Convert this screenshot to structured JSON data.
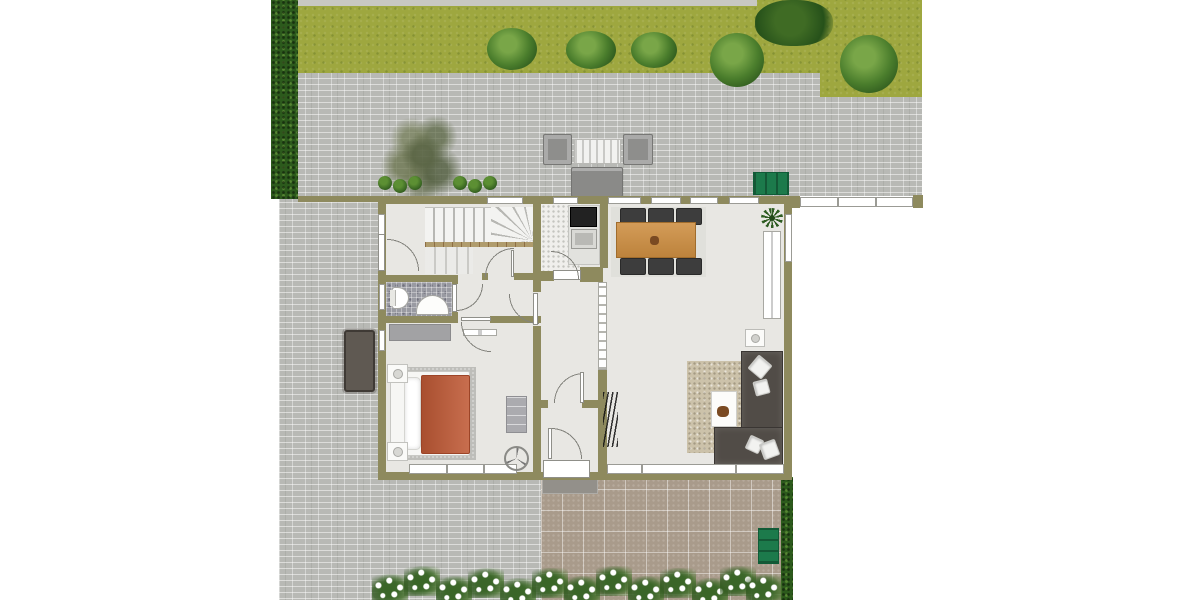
{
  "meta": {
    "title": "Ground floor plan with garden",
    "type": "floor-plan"
  },
  "palette": {
    "wall": "#8e8a5e",
    "floor": "#e8e7e3",
    "grass": "#9ea73f",
    "hedge": "#2c5a1c",
    "paver-gray": "#b8b9b5",
    "paver-brown": "#a99b8b",
    "duvet": "#c05a36",
    "sofa": "#514c47",
    "dining-table": "#cd8e41",
    "bench-green": "#1c7a4b"
  },
  "elements": [
    {
      "kind": "paver-gray",
      "name": "patio-pavers-north",
      "x": 279,
      "y": 6,
      "w": 643,
      "h": 190
    },
    {
      "kind": "grass",
      "name": "lawn",
      "x": 298,
      "y": 0,
      "w": 522,
      "h": 73
    },
    {
      "kind": "grass",
      "name": "lawn-right-extension",
      "x": 820,
      "y": 0,
      "w": 102,
      "h": 97
    },
    {
      "kind": "gravel",
      "name": "gravel-edge-strip",
      "x": 298,
      "y": 0,
      "w": 459,
      "h": 6
    },
    {
      "kind": "paver-gray",
      "name": "patio-pavers-west",
      "x": 279,
      "y": 196,
      "w": 262,
      "h": 404
    },
    {
      "kind": "paver-brown",
      "name": "terrace-pavers-south",
      "x": 541,
      "y": 468,
      "w": 241,
      "h": 132
    },
    {
      "kind": "porch-mat",
      "name": "entry-doormat",
      "x": 542,
      "y": 470,
      "w": 56,
      "h": 24
    },
    {
      "kind": "hedge",
      "name": "hedge-west",
      "x": 271,
      "y": 0,
      "w": 27,
      "h": 199
    },
    {
      "kind": "hedge",
      "name": "hedge-southeast",
      "x": 781,
      "y": 477,
      "w": 12,
      "h": 123
    },
    {
      "kind": "tree",
      "name": "garden-tree",
      "x": 380,
      "y": 110,
      "w": 82,
      "h": 90
    },
    {
      "kind": "bush",
      "name": "bush-1",
      "x": 487,
      "y": 28,
      "w": 50,
      "h": 42
    },
    {
      "kind": "bush",
      "name": "bush-2",
      "x": 566,
      "y": 31,
      "w": 50,
      "h": 38
    },
    {
      "kind": "bush",
      "name": "bush-3",
      "x": 631,
      "y": 32,
      "w": 46,
      "h": 36
    },
    {
      "kind": "bush",
      "name": "bush-4",
      "x": 710,
      "y": 33,
      "w": 54,
      "h": 54
    },
    {
      "kind": "bush",
      "name": "bush-5",
      "x": 840,
      "y": 35,
      "w": 58,
      "h": 58
    },
    {
      "kind": "bush-dark",
      "name": "large-bush",
      "x": 755,
      "y": 0,
      "w": 78,
      "h": 46
    },
    {
      "kind": "shrub",
      "name": "shrub-1",
      "x": 378,
      "y": 176,
      "w": 14,
      "h": 14
    },
    {
      "kind": "shrub",
      "name": "shrub-2",
      "x": 393,
      "y": 179,
      "w": 14,
      "h": 14
    },
    {
      "kind": "shrub",
      "name": "shrub-3",
      "x": 408,
      "y": 176,
      "w": 14,
      "h": 14
    },
    {
      "kind": "shrub",
      "name": "shrub-4",
      "x": 453,
      "y": 176,
      "w": 14,
      "h": 14
    },
    {
      "kind": "shrub",
      "name": "shrub-5",
      "x": 468,
      "y": 179,
      "w": 14,
      "h": 14
    },
    {
      "kind": "shrub",
      "name": "shrub-6",
      "x": 483,
      "y": 176,
      "w": 14,
      "h": 14
    },
    {
      "kind": "garden-chair",
      "name": "patio-chair-left",
      "x": 543,
      "y": 134,
      "w": 29,
      "h": 31
    },
    {
      "kind": "garden-table",
      "name": "patio-table",
      "x": 574,
      "y": 139,
      "w": 47,
      "h": 25
    },
    {
      "kind": "garden-chair",
      "name": "patio-chair-right",
      "x": 623,
      "y": 134,
      "w": 30,
      "h": 31
    },
    {
      "kind": "garden-sofa",
      "name": "patio-sofa",
      "x": 571,
      "y": 167,
      "w": 52,
      "h": 30
    },
    {
      "kind": "bench-h",
      "name": "garden-bench-north",
      "x": 753,
      "y": 172,
      "w": 36,
      "h": 23
    },
    {
      "kind": "bench-v",
      "name": "garden-bench-south",
      "x": 758,
      "y": 528,
      "w": 21,
      "h": 36
    },
    {
      "kind": "outdoor-table-dark",
      "name": "terrace-table-west",
      "x": 344,
      "y": 330,
      "w": 31,
      "h": 62
    },
    {
      "kind": "flowers",
      "name": "flower-cluster-1",
      "x": 372,
      "y": 574,
      "w": 36,
      "h": 30
    },
    {
      "kind": "flowers",
      "name": "flower-cluster-2",
      "x": 404,
      "y": 566,
      "w": 36,
      "h": 30
    },
    {
      "kind": "flowers",
      "name": "flower-cluster-3",
      "x": 436,
      "y": 576,
      "w": 36,
      "h": 30
    },
    {
      "kind": "flowers",
      "name": "flower-cluster-4",
      "x": 468,
      "y": 568,
      "w": 36,
      "h": 30
    },
    {
      "kind": "flowers",
      "name": "flower-cluster-5",
      "x": 500,
      "y": 578,
      "w": 36,
      "h": 30
    },
    {
      "kind": "flowers",
      "name": "flower-cluster-6",
      "x": 532,
      "y": 568,
      "w": 36,
      "h": 30
    },
    {
      "kind": "flowers",
      "name": "flower-cluster-7",
      "x": 564,
      "y": 576,
      "w": 36,
      "h": 30
    },
    {
      "kind": "flowers",
      "name": "flower-cluster-8",
      "x": 596,
      "y": 566,
      "w": 36,
      "h": 30
    },
    {
      "kind": "flowers",
      "name": "flower-cluster-9",
      "x": 628,
      "y": 576,
      "w": 36,
      "h": 30
    },
    {
      "kind": "flowers",
      "name": "flower-cluster-10",
      "x": 660,
      "y": 568,
      "w": 36,
      "h": 30
    },
    {
      "kind": "flowers",
      "name": "flower-cluster-11",
      "x": 692,
      "y": 578,
      "w": 36,
      "h": 30
    },
    {
      "kind": "flowers",
      "name": "flower-cluster-12",
      "x": 720,
      "y": 566,
      "w": 36,
      "h": 30
    },
    {
      "kind": "flowers",
      "name": "flower-cluster-13",
      "x": 746,
      "y": 574,
      "w": 36,
      "h": 30
    },
    {
      "kind": "wall",
      "name": "house-outer-walls",
      "x": 378,
      "y": 196,
      "w": 414,
      "h": 284
    },
    {
      "kind": "floor",
      "name": "house-floor",
      "x": 386,
      "y": 204,
      "w": 398,
      "h": 268
    },
    {
      "kind": "floor-speckle",
      "name": "kitchen-floor",
      "x": 541,
      "y": 204,
      "w": 40,
      "h": 67
    },
    {
      "kind": "mosaic",
      "name": "bathroom-floor",
      "x": 386,
      "y": 282,
      "w": 66,
      "h": 34
    },
    {
      "kind": "stairs-h",
      "name": "stair-upper-flight",
      "x": 425,
      "y": 207,
      "w": 66,
      "h": 35
    },
    {
      "kind": "stairs-fan",
      "name": "stair-winders",
      "x": 491,
      "y": 207,
      "w": 43,
      "h": 35
    },
    {
      "kind": "stringer",
      "name": "stair-stringer",
      "x": 425,
      "y": 242,
      "w": 109,
      "h": 5
    },
    {
      "kind": "stairs-l",
      "name": "stair-lower-flight",
      "x": 425,
      "y": 247,
      "w": 48,
      "h": 27
    },
    {
      "kind": "rug-bed",
      "name": "bedroom-rug",
      "x": 399,
      "y": 367,
      "w": 77,
      "h": 93
    },
    {
      "kind": "bed",
      "name": "bed-frame",
      "x": 390,
      "y": 371,
      "w": 80,
      "h": 85
    },
    {
      "kind": "pillow",
      "name": "bed-pillows",
      "x": 404,
      "y": 377,
      "w": 17,
      "h": 73
    },
    {
      "kind": "duvet",
      "name": "bed-duvet",
      "x": 421,
      "y": 375,
      "w": 49,
      "h": 79
    },
    {
      "kind": "nightstand",
      "name": "nightstand-north",
      "x": 387,
      "y": 364,
      "w": 21,
      "h": 19
    },
    {
      "kind": "nightstand",
      "name": "nightstand-south",
      "x": 387,
      "y": 442,
      "w": 21,
      "h": 19
    },
    {
      "kind": "wardrobe",
      "name": "bedroom-wardrobe",
      "x": 389,
      "y": 324,
      "w": 62,
      "h": 17
    },
    {
      "kind": "dresser",
      "name": "bedroom-dresser",
      "x": 506,
      "y": 396,
      "w": 21,
      "h": 37
    },
    {
      "kind": "radiator",
      "name": "bedroom-radiator",
      "x": 463,
      "y": 329,
      "w": 34,
      "h": 7
    },
    {
      "kind": "toilet",
      "name": "toilet",
      "x": 390,
      "y": 287,
      "w": 19,
      "h": 22
    },
    {
      "kind": "sink-bath",
      "name": "bathroom-sink",
      "x": 416,
      "y": 295,
      "w": 33,
      "h": 20
    },
    {
      "kind": "counter",
      "name": "kitchen-counter",
      "x": 568,
      "y": 205,
      "w": 32,
      "h": 60
    },
    {
      "kind": "cooktop",
      "name": "cooktop",
      "x": 570,
      "y": 207,
      "w": 27,
      "h": 20
    },
    {
      "kind": "sink-kitchen",
      "name": "kitchen-sink",
      "x": 571,
      "y": 229,
      "w": 26,
      "h": 20
    },
    {
      "kind": "mat-dining",
      "name": "dining-mat",
      "x": 611,
      "y": 207,
      "w": 95,
      "h": 70
    },
    {
      "kind": "chair",
      "name": "dining-chair-1",
      "x": 620,
      "y": 208,
      "w": 26,
      "h": 17
    },
    {
      "kind": "chair",
      "name": "dining-chair-2",
      "x": 648,
      "y": 208,
      "w": 26,
      "h": 17
    },
    {
      "kind": "chair",
      "name": "dining-chair-3",
      "x": 676,
      "y": 208,
      "w": 26,
      "h": 17
    },
    {
      "kind": "chair",
      "name": "dining-chair-4",
      "x": 620,
      "y": 258,
      "w": 26,
      "h": 17
    },
    {
      "kind": "chair",
      "name": "dining-chair-5",
      "x": 648,
      "y": 258,
      "w": 26,
      "h": 17
    },
    {
      "kind": "chair",
      "name": "dining-chair-6",
      "x": 676,
      "y": 258,
      "w": 26,
      "h": 17
    },
    {
      "kind": "table-wood",
      "name": "dining-table",
      "x": 616,
      "y": 222,
      "w": 80,
      "h": 36
    },
    {
      "kind": "decor",
      "name": "table-centerpiece",
      "x": 650,
      "y": 236,
      "w": 9,
      "h": 9
    },
    {
      "kind": "plant",
      "name": "potted-plant",
      "x": 761,
      "y": 208,
      "w": 22,
      "h": 20
    },
    {
      "kind": "radiator",
      "name": "living-radiator",
      "x": 763,
      "y": 231,
      "w": 18,
      "h": 88
    },
    {
      "kind": "lamp-table",
      "name": "side-table",
      "x": 745,
      "y": 329,
      "w": 20,
      "h": 18
    },
    {
      "kind": "rug-living",
      "name": "living-rug",
      "x": 687,
      "y": 361,
      "w": 57,
      "h": 92
    },
    {
      "kind": "coffee-table",
      "name": "coffee-table",
      "x": 711,
      "y": 391,
      "w": 26,
      "h": 36
    },
    {
      "kind": "decor",
      "name": "coffee-table-decor",
      "x": 717,
      "y": 406,
      "w": 12,
      "h": 11
    },
    {
      "kind": "sofa",
      "name": "sofa-chaise",
      "x": 741,
      "y": 351,
      "w": 42,
      "h": 114
    },
    {
      "kind": "sofa",
      "name": "sofa-base",
      "x": 714,
      "y": 427,
      "w": 69,
      "h": 38
    },
    {
      "kind": "sofa-pillow",
      "name": "sofa-pillow-1",
      "x": 751,
      "y": 358,
      "w": 18,
      "h": 18,
      "rot": 40
    },
    {
      "kind": "sofa-pillow",
      "name": "sofa-pillow-2",
      "x": 754,
      "y": 380,
      "w": 15,
      "h": 15,
      "rot": -15
    },
    {
      "kind": "sofa-pillow",
      "name": "sofa-pillow-3",
      "x": 747,
      "y": 437,
      "w": 15,
      "h": 15,
      "rot": 25
    },
    {
      "kind": "sofa-pillow",
      "name": "sofa-pillow-4",
      "x": 761,
      "y": 441,
      "w": 17,
      "h": 17,
      "rot": -20
    },
    {
      "kind": "wall",
      "name": "wall-core-west",
      "x": 533,
      "y": 204,
      "w": 8,
      "h": 268
    },
    {
      "kind": "floor",
      "name": "corridor-door-gap",
      "x": 533,
      "y": 292,
      "w": 8,
      "h": 34
    },
    {
      "kind": "wall",
      "name": "wall-core-east-upper",
      "x": 600,
      "y": 204,
      "w": 8,
      "h": 64
    },
    {
      "kind": "wall",
      "name": "wall-kitchen-east-chunk",
      "x": 580,
      "y": 267,
      "w": 23,
      "h": 15
    },
    {
      "kind": "opening",
      "name": "living-passage-opening",
      "x": 598,
      "y": 282,
      "w": 9,
      "h": 88
    },
    {
      "kind": "wall",
      "name": "wall-core-east-lower",
      "x": 598,
      "y": 370,
      "w": 9,
      "h": 102
    },
    {
      "kind": "wall",
      "name": "bathroom-north-wall",
      "x": 386,
      "y": 275,
      "w": 66,
      "h": 7
    },
    {
      "kind": "wall",
      "name": "stairhall-south-wall",
      "x": 482,
      "y": 273,
      "w": 59,
      "h": 7
    },
    {
      "kind": "floor",
      "name": "stairhall-door-gap",
      "x": 488,
      "y": 273,
      "w": 26,
      "h": 7
    },
    {
      "kind": "wall",
      "name": "bathroom-south-wall",
      "x": 386,
      "y": 316,
      "w": 66,
      "h": 7
    },
    {
      "kind": "wall",
      "name": "bedroom-north-wall",
      "x": 452,
      "y": 316,
      "w": 89,
      "h": 7
    },
    {
      "kind": "floor",
      "name": "bedroom-door-gap",
      "x": 458,
      "y": 316,
      "w": 32,
      "h": 7
    },
    {
      "kind": "wall",
      "name": "bathroom-east-wall",
      "x": 452,
      "y": 275,
      "w": 6,
      "h": 41
    },
    {
      "kind": "floor",
      "name": "bathroom-door-gap",
      "x": 452,
      "y": 284,
      "w": 6,
      "h": 28
    },
    {
      "kind": "wall",
      "name": "kitchen-south-wall",
      "x": 541,
      "y": 271,
      "w": 13,
      "h": 10
    },
    {
      "kind": "sill",
      "name": "kitchen-door-bar",
      "x": 553,
      "y": 270,
      "w": 28,
      "h": 10
    },
    {
      "kind": "wall",
      "name": "hall-partition-wall",
      "x": 541,
      "y": 400,
      "w": 59,
      "h": 8
    },
    {
      "kind": "floor",
      "name": "hall-door-gap",
      "x": 548,
      "y": 400,
      "w": 34,
      "h": 8
    },
    {
      "kind": "window",
      "name": "window-stairhall-north",
      "x": 487,
      "y": 197,
      "w": 36,
      "h": 7
    },
    {
      "kind": "window",
      "name": "window-kitchen-north",
      "x": 553,
      "y": 197,
      "w": 25,
      "h": 7
    },
    {
      "kind": "window",
      "name": "window-living-north-1",
      "x": 608,
      "y": 197,
      "w": 33,
      "h": 7
    },
    {
      "kind": "window",
      "name": "window-living-north-2",
      "x": 651,
      "y": 197,
      "w": 30,
      "h": 7
    },
    {
      "kind": "window",
      "name": "window-living-north-3",
      "x": 690,
      "y": 197,
      "w": 28,
      "h": 7
    },
    {
      "kind": "window",
      "name": "window-living-north-4",
      "x": 729,
      "y": 197,
      "w": 30,
      "h": 7
    },
    {
      "kind": "window",
      "name": "window-hall-west",
      "x": 378,
      "y": 214,
      "w": 7,
      "h": 21
    },
    {
      "kind": "leaf",
      "name": "side-door-leaf",
      "x": 378,
      "y": 234,
      "w": 7,
      "h": 37
    },
    {
      "kind": "window",
      "name": "window-bathroom-west",
      "x": 379,
      "y": 284,
      "w": 6,
      "h": 26
    },
    {
      "kind": "window",
      "name": "window-bedroom-west",
      "x": 379,
      "y": 330,
      "w": 6,
      "h": 21
    },
    {
      "kind": "window",
      "name": "window-living-east",
      "x": 785,
      "y": 214,
      "w": 7,
      "h": 48
    },
    {
      "kind": "window",
      "name": "window-bedroom-south",
      "x": 409,
      "y": 464,
      "w": 108,
      "h": 10
    },
    {
      "kind": "mullion",
      "name": "mullion-bed-1",
      "x": 446,
      "y": 464,
      "w": 2,
      "h": 10
    },
    {
      "kind": "mullion",
      "name": "mullion-bed-2",
      "x": 483,
      "y": 464,
      "w": 2,
      "h": 10
    },
    {
      "kind": "window",
      "name": "window-living-south",
      "x": 607,
      "y": 464,
      "w": 177,
      "h": 10
    },
    {
      "kind": "mullion",
      "name": "mullion-living-1",
      "x": 641,
      "y": 464,
      "w": 2,
      "h": 10
    },
    {
      "kind": "mullion",
      "name": "mullion-living-2",
      "x": 735,
      "y": 464,
      "w": 2,
      "h": 10
    },
    {
      "kind": "sill",
      "name": "front-door-threshold",
      "x": 543,
      "y": 460,
      "w": 47,
      "h": 18
    },
    {
      "kind": "arc",
      "name": "side-door-swing",
      "x": 387,
      "y": 238,
      "rad": 33,
      "corner": "bl"
    },
    {
      "kind": "arc",
      "name": "stairhall-door-swing",
      "x": 484,
      "y": 247,
      "rad": 30,
      "corner": "br"
    },
    {
      "kind": "leaf",
      "name": "stairhall-door-leaf",
      "x": 511,
      "y": 250,
      "w": 3,
      "h": 27
    },
    {
      "kind": "arc",
      "name": "bathroom-door-swing",
      "x": 456,
      "y": 284,
      "rad": 28,
      "corner": "tl"
    },
    {
      "kind": "leaf",
      "name": "bathroom-door-leaf",
      "x": 452,
      "y": 284,
      "w": 5,
      "h": 28
    },
    {
      "kind": "arc",
      "name": "corridor-door-swing",
      "x": 508,
      "y": 294,
      "rad": 31,
      "corner": "tr"
    },
    {
      "kind": "leaf",
      "name": "corridor-door-leaf",
      "x": 533,
      "y": 293,
      "w": 5,
      "h": 32
    },
    {
      "kind": "arc",
      "name": "kitchen-door-swing",
      "x": 551,
      "y": 250,
      "rad": 29,
      "corner": "bl"
    },
    {
      "kind": "arc",
      "name": "bedroom-door-swing",
      "x": 460,
      "y": 322,
      "rad": 31,
      "corner": "tr"
    },
    {
      "kind": "leaf",
      "name": "bedroom-door-leaf",
      "x": 461,
      "y": 317,
      "w": 30,
      "h": 4
    },
    {
      "kind": "arc",
      "name": "hall-door-swing",
      "x": 553,
      "y": 372,
      "rad": 31,
      "corner": "br"
    },
    {
      "kind": "leaf",
      "name": "hall-door-leaf",
      "x": 580,
      "y": 372,
      "w": 4,
      "h": 31
    },
    {
      "kind": "arc",
      "name": "front-door-swing",
      "x": 551,
      "y": 427,
      "rad": 32,
      "corner": "bl"
    },
    {
      "kind": "leaf",
      "name": "front-door-leaf",
      "x": 548,
      "y": 428,
      "w": 4,
      "h": 31
    },
    {
      "kind": "fan",
      "name": "ceiling-fan-symbol",
      "x": 504,
      "y": 446,
      "w": 25,
      "h": 25
    },
    {
      "kind": "coat",
      "name": "coat-rack",
      "x": 603,
      "y": 392,
      "w": 15,
      "h": 55
    },
    {
      "kind": "wall",
      "name": "garden-wall-west",
      "x": 298,
      "y": 196,
      "w": 80,
      "h": 6
    },
    {
      "kind": "fence",
      "name": "fence-east",
      "x": 800,
      "y": 197,
      "w": 113,
      "h": 10
    },
    {
      "kind": "mullion",
      "name": "fence-mullion-1",
      "x": 837,
      "y": 197,
      "w": 2,
      "h": 10
    },
    {
      "kind": "mullion",
      "name": "fence-mullion-2",
      "x": 875,
      "y": 197,
      "w": 2,
      "h": 10
    },
    {
      "kind": "wall",
      "name": "fence-post-west",
      "x": 792,
      "y": 196,
      "w": 8,
      "h": 12
    },
    {
      "kind": "wall",
      "name": "fence-post-east",
      "x": 913,
      "y": 195,
      "w": 10,
      "h": 13
    }
  ]
}
